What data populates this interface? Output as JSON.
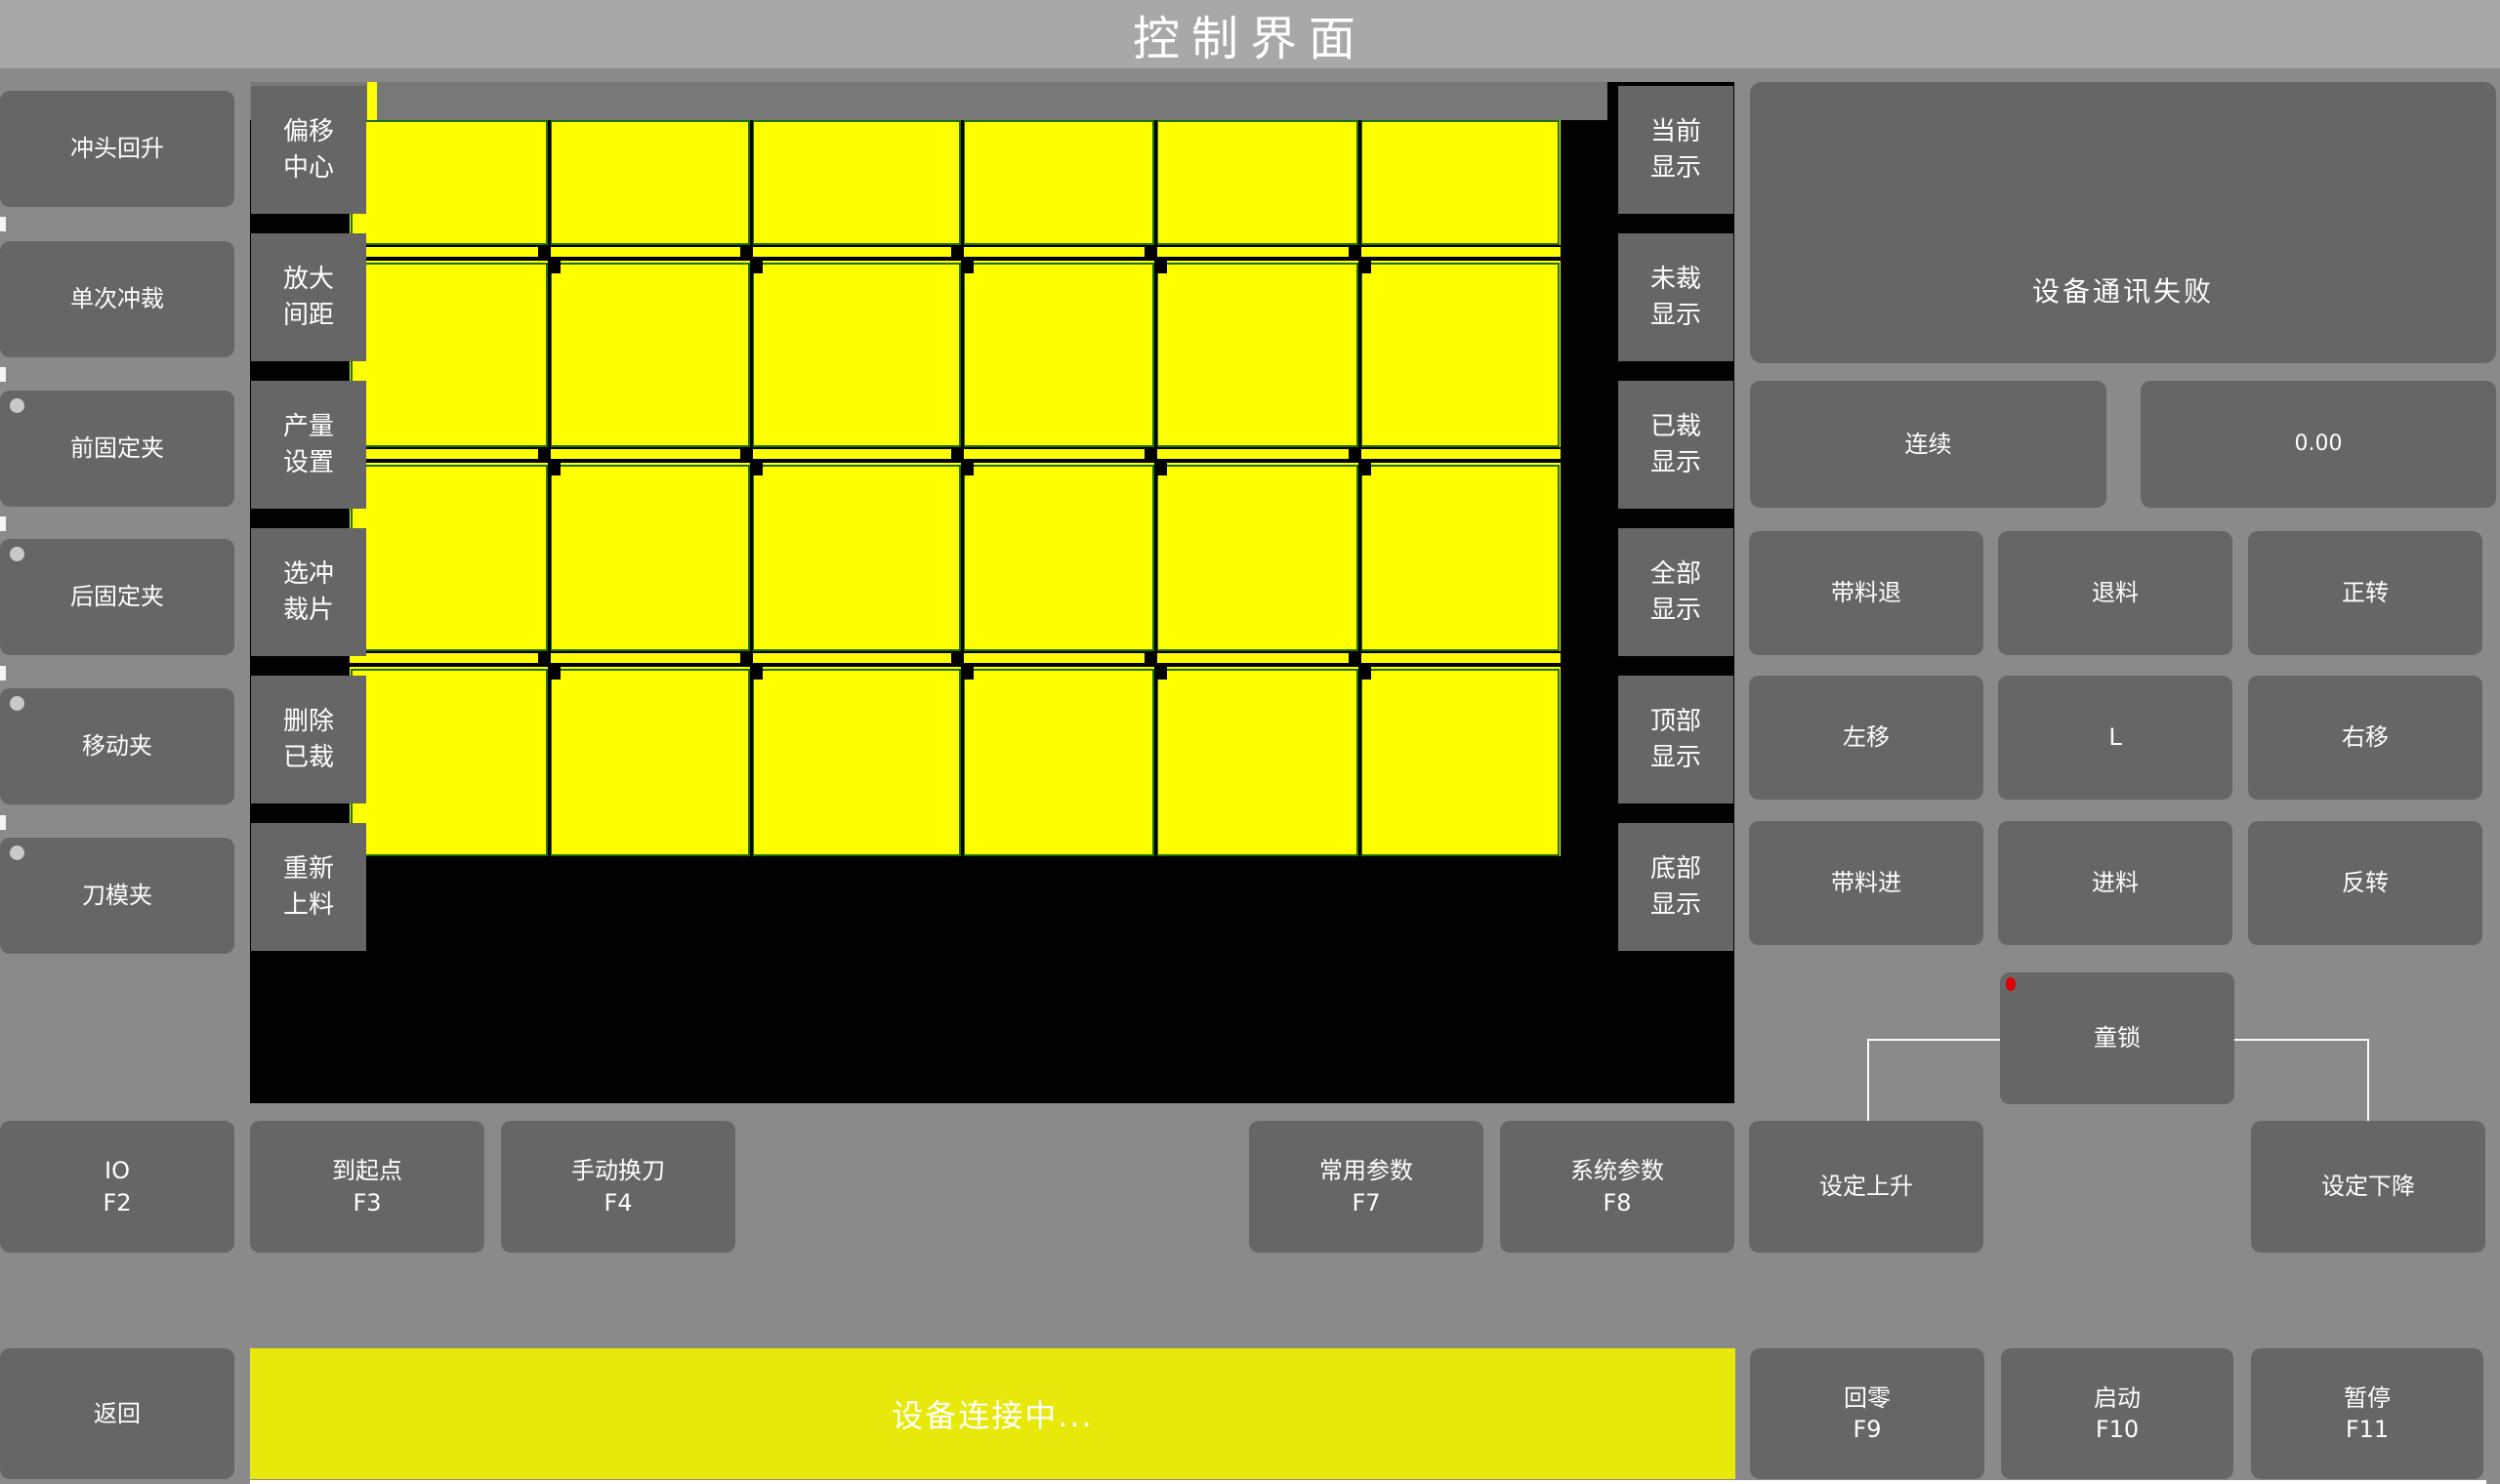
{
  "title": "控制界面",
  "left_buttons": [
    {
      "label": "冲头回升",
      "indicator": false
    },
    {
      "label": "单次冲裁",
      "indicator": false
    },
    {
      "label": "前固定夹",
      "indicator": true
    },
    {
      "label": "后固定夹",
      "indicator": true
    },
    {
      "label": "移动夹",
      "indicator": true
    },
    {
      "label": "刀模夹",
      "indicator": true
    }
  ],
  "tool_buttons": [
    {
      "line1": "偏移",
      "line2": "中心"
    },
    {
      "line1": "放大",
      "line2": "间距"
    },
    {
      "line1": "产量",
      "line2": "设置"
    },
    {
      "line1": "选冲",
      "line2": "裁片"
    },
    {
      "line1": "删除",
      "line2": "已裁"
    },
    {
      "line1": "重新",
      "line2": "上料"
    }
  ],
  "display_buttons": [
    {
      "line1": "当前",
      "line2": "显示"
    },
    {
      "line1": "未裁",
      "line2": "显示"
    },
    {
      "line1": "已裁",
      "line2": "显示"
    },
    {
      "line1": "全部",
      "line2": "显示"
    },
    {
      "line1": "顶部",
      "line2": "显示"
    },
    {
      "line1": "底部",
      "line2": "显示"
    }
  ],
  "status_panel": {
    "message": "设备通讯失败"
  },
  "mode_button": {
    "label": "连续"
  },
  "counter_display": {
    "value": "0.00"
  },
  "jog_buttons": [
    "带料退",
    "退料",
    "正转",
    "左移",
    "L",
    "右移",
    "带料进",
    "进料",
    "反转"
  ],
  "child_lock": {
    "label": "童锁",
    "indicator_color": "#dd0000"
  },
  "function_keys": [
    {
      "label": "IO",
      "key": "F2"
    },
    {
      "label": "到起点",
      "key": "F3"
    },
    {
      "label": "手动换刀",
      "key": "F4"
    },
    {
      "label": "常用参数",
      "key": "F7"
    },
    {
      "label": "系统参数",
      "key": "F8"
    }
  ],
  "setting_buttons": [
    "设定上升",
    "设定下降"
  ],
  "bottom_bar": {
    "back": "返回",
    "status_message": "设备连接中...",
    "keys": [
      {
        "label": "回零",
        "key": "F9"
      },
      {
        "label": "启动",
        "key": "F10"
      },
      {
        "label": "暂停",
        "key": "F11"
      }
    ]
  },
  "pieces_grid": {
    "columns": 6,
    "rows": 4
  },
  "colors": {
    "piece_yellow": "#ffff00",
    "piece_border_green": "#1e6e00",
    "status_bar_yellow": "#e8e80b",
    "button_gray": "#666666",
    "canvas_black": "#000000",
    "alarm_red": "#dd0000"
  }
}
